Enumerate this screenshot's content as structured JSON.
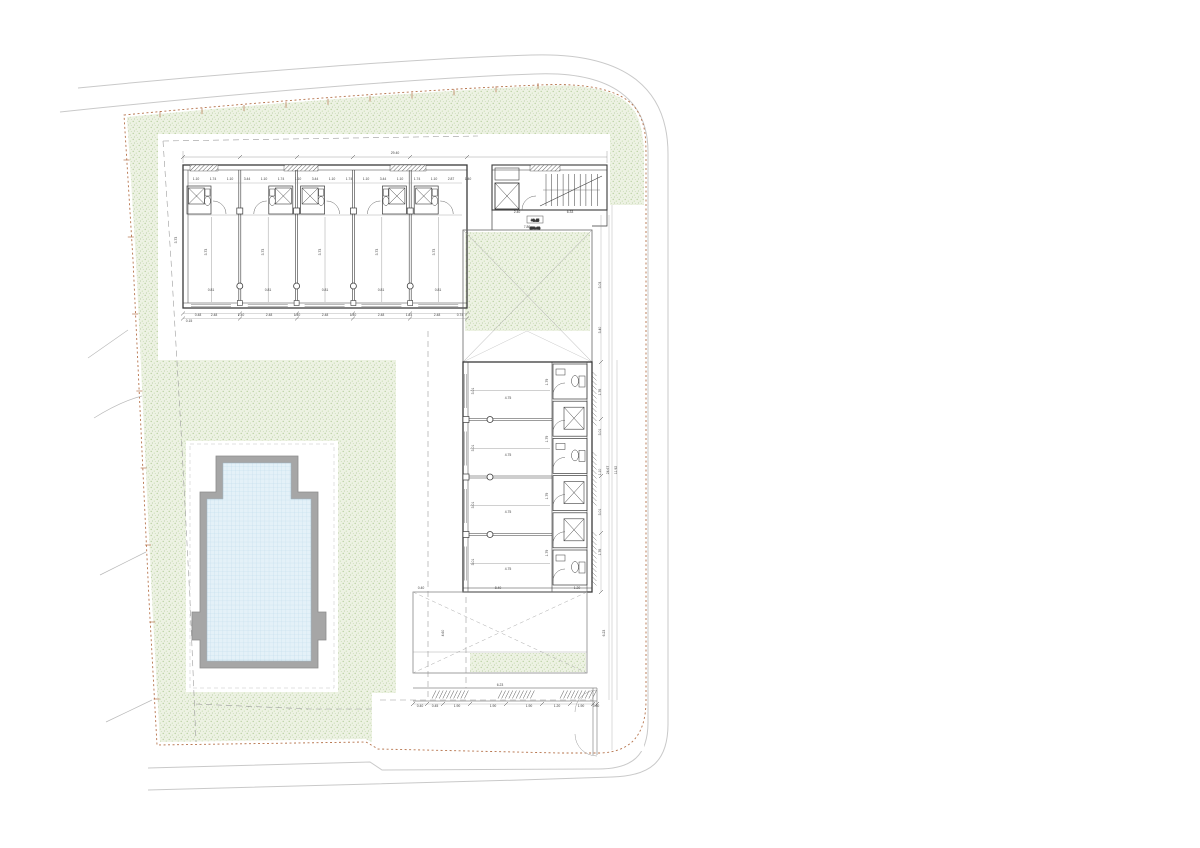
{
  "drawing": {
    "kind_label": "site-plan",
    "level_marker": {
      "value": "+0.45",
      "elevation": "(159.48)"
    },
    "building": {
      "top_wing_units": 5,
      "side_wing_rooms": 4,
      "side_wing_bath_pods": 6,
      "stair_treads": 10
    },
    "palette": {
      "grass_base": "#edf2e3",
      "grass_dot1": "#b8cf9e",
      "grass_dot2": "#cadfb4",
      "water_base": "#e4f1f8",
      "water_grid": "#bcd9ea",
      "pool_coping": "#a6a6a6",
      "line_dark": "#3a3a3a",
      "line_light": "#c9c9c9",
      "boundary": "#b5724a",
      "dash": "#999999",
      "dim_text": "#444444"
    },
    "dimension_labels": [
      [
        395,
        154,
        "29.40"
      ],
      [
        196,
        180,
        "1.10"
      ],
      [
        213,
        180,
        "1.74"
      ],
      [
        230,
        180,
        "1.10"
      ],
      [
        247,
        180,
        "3.44"
      ],
      [
        264,
        180,
        "1.10"
      ],
      [
        281,
        180,
        "1.74"
      ],
      [
        298,
        180,
        "1.10"
      ],
      [
        315,
        180,
        "3.44"
      ],
      [
        332,
        180,
        "1.10"
      ],
      [
        349,
        180,
        "1.74"
      ],
      [
        366,
        180,
        "1.10"
      ],
      [
        383,
        180,
        "3.44"
      ],
      [
        400,
        180,
        "1.10"
      ],
      [
        417,
        180,
        "1.74"
      ],
      [
        434,
        180,
        "1.10"
      ],
      [
        451,
        180,
        "2.87"
      ],
      [
        468,
        180,
        "1.40"
      ],
      [
        570,
        213,
        "6.33"
      ],
      [
        517,
        213,
        "2.40"
      ],
      [
        527,
        228,
        "7.86"
      ],
      [
        211,
        291,
        "0.81"
      ],
      [
        268,
        291,
        "0.81"
      ],
      [
        325,
        291,
        "0.81"
      ],
      [
        381,
        291,
        "0.81"
      ],
      [
        438,
        291,
        "0.81"
      ],
      [
        207,
        252,
        "3.73",
        -90
      ],
      [
        264,
        252,
        "3.73",
        -90
      ],
      [
        321,
        252,
        "3.73",
        -90
      ],
      [
        378,
        252,
        "3.73",
        -90
      ],
      [
        435,
        252,
        "3.73",
        -90
      ],
      [
        198,
        316,
        "0.48"
      ],
      [
        214,
        316,
        "2.48"
      ],
      [
        241,
        316,
        "1.40"
      ],
      [
        269,
        316,
        "2.48"
      ],
      [
        297,
        316,
        "1.40"
      ],
      [
        325,
        316,
        "2.48"
      ],
      [
        353,
        316,
        "1.40"
      ],
      [
        381,
        316,
        "2.48"
      ],
      [
        409,
        316,
        "1.14"
      ],
      [
        437,
        316,
        "2.48"
      ],
      [
        460,
        316,
        "0.74"
      ],
      [
        177,
        240,
        "3.73",
        -90
      ],
      [
        189,
        322,
        "0.15"
      ],
      [
        508,
        399,
        "4.75"
      ],
      [
        508,
        456,
        "4.75"
      ],
      [
        508,
        513,
        "4.75"
      ],
      [
        508,
        570,
        "4.75"
      ],
      [
        474,
        391,
        "3.01",
        -90
      ],
      [
        474,
        448,
        "3.01",
        -90
      ],
      [
        474,
        505,
        "3.01",
        -90
      ],
      [
        474,
        562,
        "3.01",
        -90
      ],
      [
        548,
        382,
        "1.79",
        -90
      ],
      [
        548,
        439,
        "1.79",
        -90
      ],
      [
        548,
        496,
        "1.79",
        -90
      ],
      [
        548,
        553,
        "1.79",
        -90
      ],
      [
        601,
        285,
        "3.03",
        -90
      ],
      [
        601,
        330,
        "3.40",
        -90
      ],
      [
        601,
        392,
        "1.76",
        -90
      ],
      [
        601,
        432,
        "3.01",
        -90
      ],
      [
        601,
        472,
        "1.10",
        -90
      ],
      [
        601,
        512,
        "3.01",
        -90
      ],
      [
        601,
        552,
        "1.76",
        -90
      ],
      [
        609,
        470,
        "24.67",
        -90
      ],
      [
        617,
        470,
        "11.92",
        -90
      ],
      [
        498,
        589,
        "8.40"
      ],
      [
        577,
        589,
        "1.20"
      ],
      [
        421,
        589,
        "0.40"
      ],
      [
        444,
        633,
        "4.60",
        -90
      ],
      [
        605,
        633,
        "6.23",
        -90
      ],
      [
        500,
        686,
        "6.23"
      ],
      [
        420,
        707,
        "0.40"
      ],
      [
        435,
        707,
        "0.45"
      ],
      [
        457,
        707,
        "1.90"
      ],
      [
        493,
        707,
        "1.90"
      ],
      [
        529,
        707,
        "1.90"
      ],
      [
        557,
        707,
        "1.20"
      ],
      [
        581,
        707,
        "1.90"
      ],
      [
        596,
        707,
        "0.40"
      ]
    ]
  }
}
